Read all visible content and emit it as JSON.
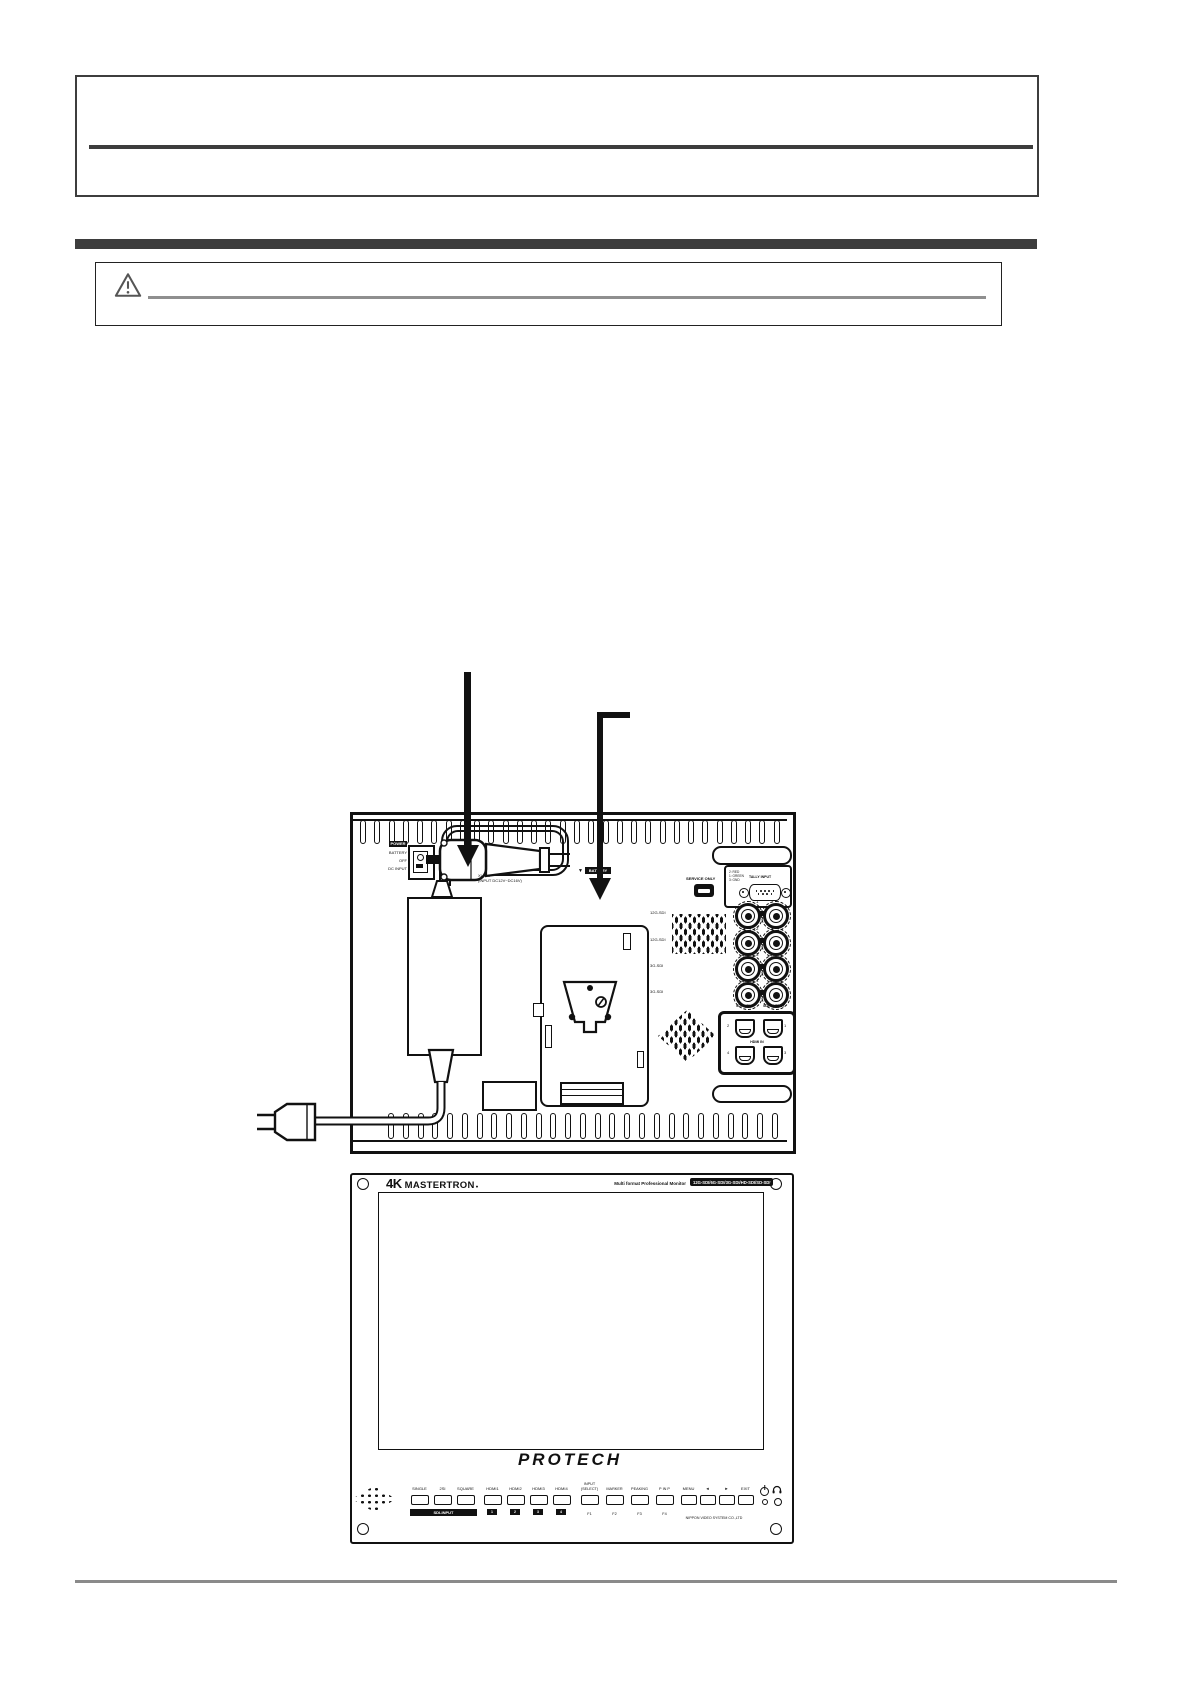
{
  "rear_diagram": {
    "power_block": {
      "power": "POWER",
      "battery": "BATTERY",
      "off": "OFF",
      "dc_input": "DC INPUT"
    },
    "xlr_label": {
      "line1": "XLR 4P",
      "line2": "(INPUT DC12V~DC16V)"
    },
    "battery_pointer": {
      "arrow": "▼",
      "label": "BATTERY"
    },
    "service_only_label": "SERVICE ONLY",
    "tally": {
      "pin_lines": [
        "2: RED",
        "1: GREEN",
        "3: GND"
      ],
      "label": "TALLY INPUT"
    },
    "sdi": {
      "rows": [
        {
          "num": "1",
          "label": "12G-SDI"
        },
        {
          "num": "2",
          "label": "12G-SDI"
        },
        {
          "num": "3",
          "label": "3G-SDI"
        },
        {
          "num": "4",
          "label": "3G-SDI"
        }
      ],
      "input_label": "SDI-INPUT",
      "output_label": "SDI-OUTPUT"
    },
    "hdmi": {
      "label": "HDMI IN",
      "port_nums": [
        "2",
        "1",
        "4",
        "3"
      ]
    }
  },
  "front_panel": {
    "brand": {
      "prefix": "4K",
      "name": "MASTERTRON",
      "mark": "●"
    },
    "subtitle": "Multi format Professional Monitor",
    "badge": "12G-SDI/6G-SDI/3G-SDI/HD-SDI/SD-SDI",
    "logo": "PROTECH",
    "sdi_group": {
      "buttons": [
        "SINGLE",
        "2SI",
        "SQUARE"
      ],
      "bar": "SDI-INPUT"
    },
    "hdmi_group": {
      "buttons": [
        "HDMI1",
        "HDMI2",
        "HDMI3",
        "HDMI4"
      ],
      "chips": [
        "1",
        "2",
        "3",
        "4"
      ]
    },
    "func_group": [
      {
        "top": "INPUT",
        "bottom": "(SELECT)",
        "sub": "F1"
      },
      {
        "top": "",
        "bottom": "MARKER",
        "sub": "F2"
      },
      {
        "top": "",
        "bottom": "PEAKING",
        "sub": "F3"
      },
      {
        "top": "",
        "bottom": "P IN P",
        "sub": "F4"
      }
    ],
    "menu_group": [
      "MENU",
      "◄",
      "►",
      "EXIT"
    ],
    "maker": "NIPPON VIDEO SYSTEM CO.,LTD"
  }
}
